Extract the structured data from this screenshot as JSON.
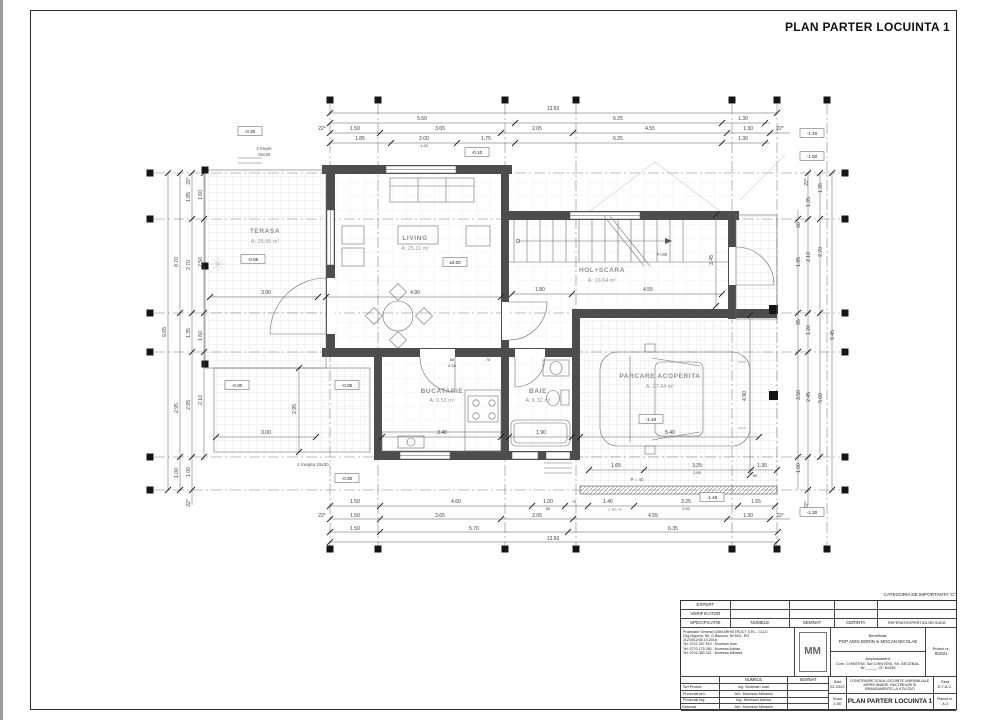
{
  "sheet": {
    "title": "PLAN PARTER LOCUINTA 1",
    "category_note": "CATEGORIA DE IMPORTANTA \"C\""
  },
  "rooms": [
    {
      "name": "TERASA",
      "area": "A: 25.95 m²"
    },
    {
      "name": "LIVING",
      "area": "A: 25.11 m²"
    },
    {
      "name": "HOL+SCARA",
      "area": "A: 16.64 m²"
    },
    {
      "name": "BUCATARIE",
      "area": "A: 9.53 m²"
    },
    {
      "name": "BAIE",
      "area": "A: 6.32 m²"
    },
    {
      "name": "PARCARE ACOPERITA",
      "area": "A: 27.44 m²"
    }
  ],
  "levels": [
    "-0.30",
    "-0.10",
    "-0.05",
    "±0.00",
    "-0.30",
    "-0.05",
    "-0.30",
    "-1.40",
    "-1.45",
    "-1.40",
    "-1.50",
    "-1.30"
  ],
  "annotations": {
    "stair_parapet": "P=90",
    "parking_parapet": "P = 40",
    "one_step": "1 treapta 15x30",
    "two_steps": "2 trepte",
    "two_steps_size": "15x30",
    "slope": "4.55 %"
  },
  "dims": {
    "top1": [
      "13.50"
    ],
    "top2": [
      "5.60",
      "6.25",
      "1.30"
    ],
    "top3": [
      "22°",
      "1.50",
      "3.65",
      "2.05",
      "4.55",
      "1.30",
      "22°"
    ],
    "top4": [
      "1.85",
      "2.00",
      "1.20",
      "1.75",
      "6.25",
      "1.30"
    ],
    "bot1": [
      "1.50",
      "4.60",
      "1.00",
      "80",
      "70",
      "1.40",
      "3.25",
      "2.00",
      "1.65"
    ],
    "bot2": [
      "22°",
      "1.50",
      "3.65",
      "2.05",
      "4.55",
      "1.30",
      "22°"
    ],
    "bot3": [
      "1.50",
      "5.70",
      "6.35"
    ],
    "bot4": [
      "13.50"
    ],
    "left": [
      "9.65",
      "8.70",
      "2.95",
      "1.00",
      "1.85",
      "2.70",
      "1.35",
      "2.95",
      "1.00",
      "1.60",
      "2.50",
      "1.60",
      "2.10",
      "22°",
      "22°"
    ],
    "right": [
      "9.45",
      "1.35",
      "2.70",
      "5.60",
      "1.35",
      "2.10",
      "1.20",
      "2.45",
      "60",
      "1.95",
      "85",
      "3.50",
      "1.00",
      "22°",
      "22°"
    ],
    "inner": [
      "3.90",
      "4.90",
      "1.80",
      "4.55",
      "2.45",
      "3.40",
      "1.90",
      "5.40",
      "4.90",
      "3.00",
      "2.95",
      "80",
      "2.18",
      "70",
      "1.65",
      "3.25",
      "2.00",
      "1.30",
      "50"
    ]
  },
  "titleblock": {
    "expert": "EXPERT",
    "verificator": "VERIFICATOR",
    "header": [
      "SPECIFICATIE",
      "NUMELE",
      "SEMNAT",
      "CERINTA",
      "REFERAT/EXPERTIZA NR./DATA"
    ],
    "company": [
      "Proiectant General:CMM ARHISTRUCT S.R.L. CLUJ",
      "Cluj-Napoca, Str. G.Bacovia, Nr.9A/1, RO",
      "J12/3012/05.10.2016",
      "Tel: 0722 267 510 - Muresan Ioan",
      "Tel: 0723 175 280 - Muresan Adrian",
      "Tel: 0724 380 321 - Muresan Mihaela"
    ],
    "logo": "MM",
    "beneficiar_label": "Beneficiar:",
    "beneficiar": "POP ADIN DORIN si MOCAN NICOLAE",
    "amplasament_label": "Amplasament:",
    "amplasament1": "Com. CHINTENI, Sat CHINTENI, Str. DECEBAL,",
    "amplasament2": "Nr._____, CF 61933",
    "proiect_label": "Proiect nr.",
    "proiect_nr": "9/2021",
    "numele": "NUMELE",
    "semnat": "SEMNAT",
    "roles": [
      {
        "role": "Sef Proiect",
        "name": "Ing. Muresan Ioan"
      },
      {
        "role": "Proiectat Arh.",
        "name": "Arh. Muresan Mihaela"
      },
      {
        "role": "Proiectat Ing.",
        "name": "Ing. Muresan Adrian"
      },
      {
        "role": "Desenat",
        "name": "Arh. Muresan Mihaela"
      }
    ],
    "data_label": "Data",
    "data": "02.2022",
    "obiect_label": "Obiect:",
    "obiect_lines": [
      "CONSTRUIRE DOUA LOCUINTE UNIFAMILIALE,",
      "IMPREJMUIRE, RACORDURI SI",
      "BRANSAMENTE LA UTILITATI"
    ],
    "faza_label": "Faza",
    "faza": "D.T.A.C.",
    "scara_label": "Scara",
    "scara": "1:50",
    "plansa_label": "Plansa nr.",
    "plansa": "A.3"
  }
}
